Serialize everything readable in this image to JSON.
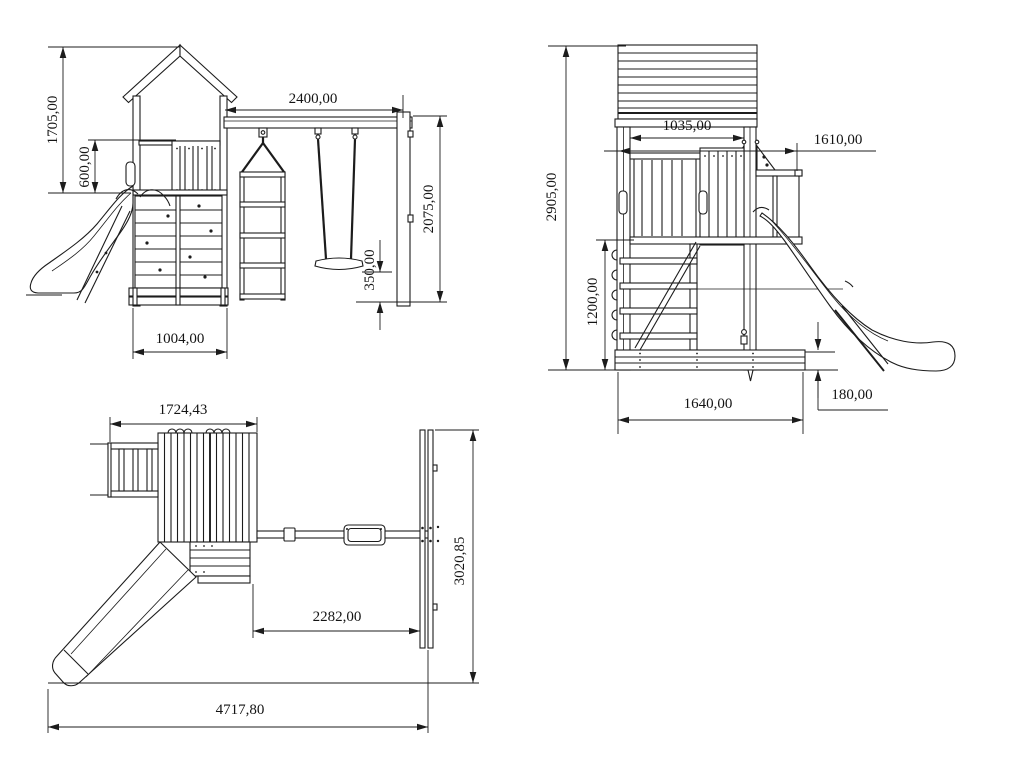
{
  "page": {
    "background": "#ffffff",
    "line_color": "#1c1c1c",
    "text_color": "#141414",
    "description": "Technical dimension drawing of a playground tower with slide, swing and rope ladder; three orthographic views"
  },
  "views": {
    "front": {
      "name": "front-elevation",
      "dims": {
        "height_total": "1705,00",
        "rail_height": "600,00",
        "beam_length": "2400,00",
        "swing_frame_height": "2075,00",
        "seat_height": "350,00",
        "tower_width": "1004,00"
      }
    },
    "side": {
      "name": "side-elevation",
      "dims": {
        "overall_height": "2905,00",
        "inner_width": "1035,00",
        "beam_offset": "1610,00",
        "ladder_height": "1200,00",
        "base_width": "1640,00",
        "frame_height": "180,00"
      }
    },
    "plan": {
      "name": "top-plan-view",
      "dims": {
        "tower_depth": "1724,43",
        "swing_bay_length": "2282,00",
        "overall_depth": "3020,85",
        "overall_length": "4717,80"
      }
    }
  }
}
